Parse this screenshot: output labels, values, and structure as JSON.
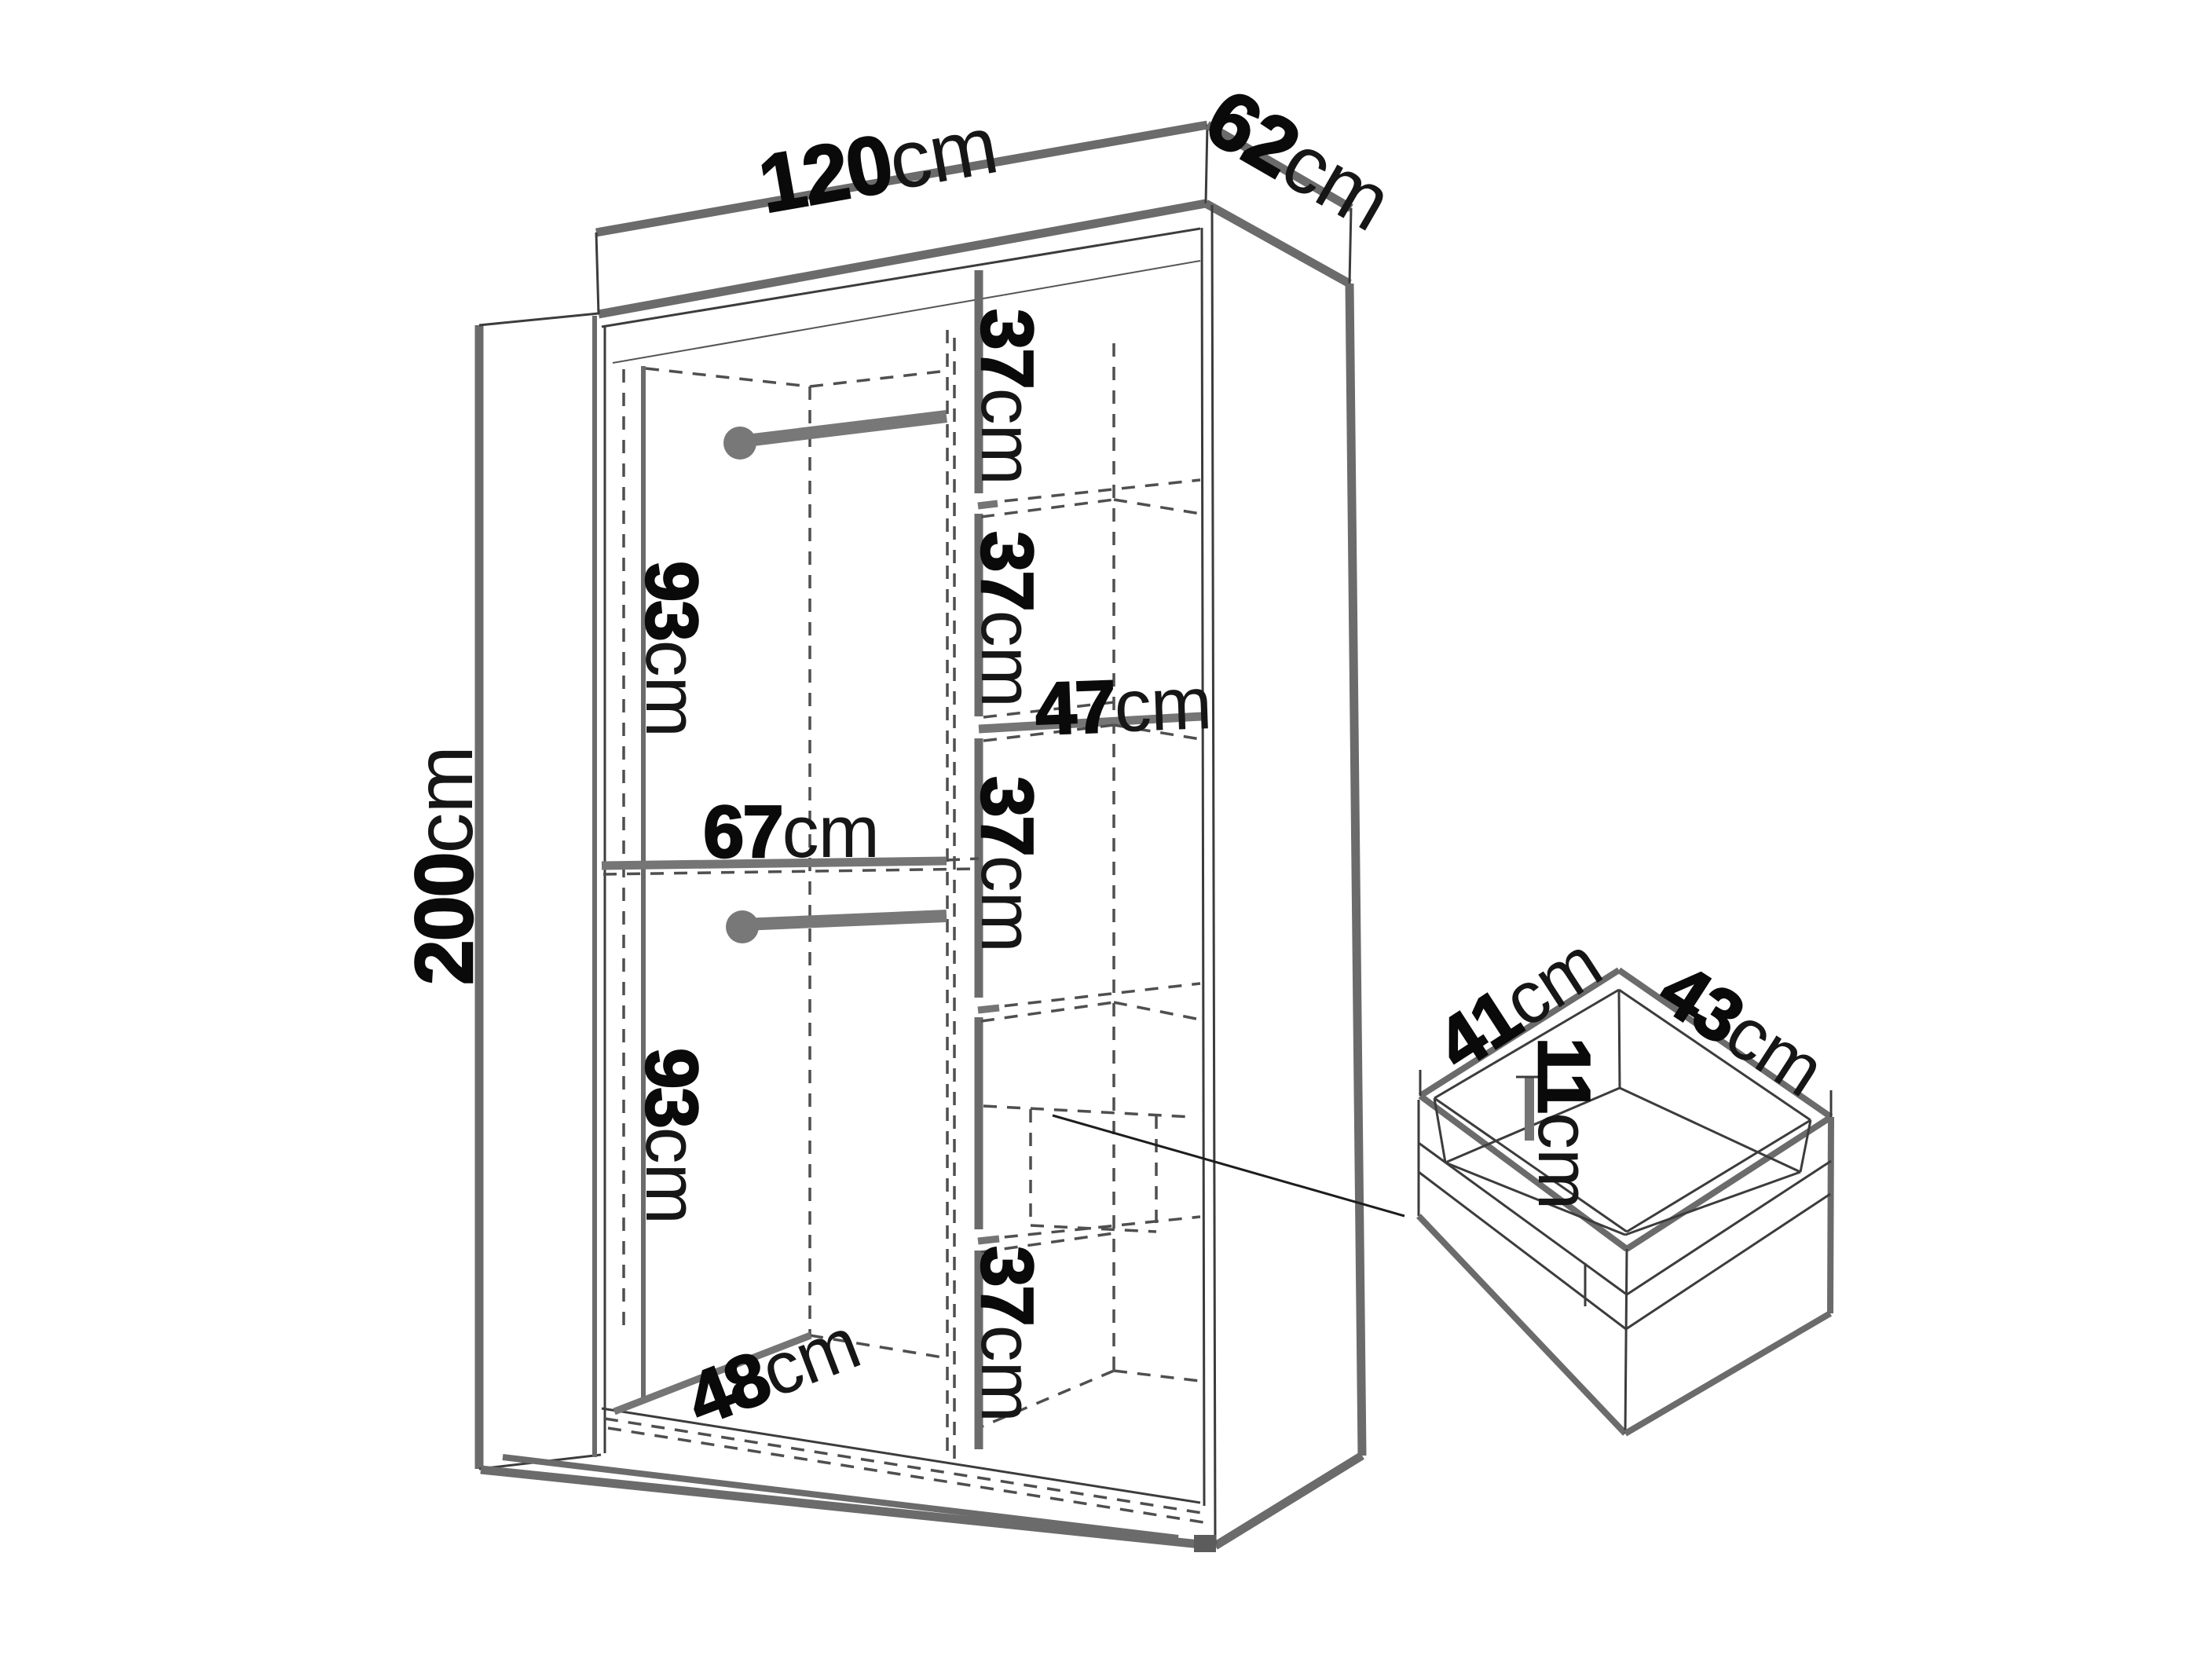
{
  "diagram": {
    "kind": "wardrobe-dimension-diagram",
    "unit": "cm",
    "colors": {
      "background": "#ffffff",
      "thick_line": "#6b6b6b",
      "thin_line": "#3c3c3c",
      "dashed_line": "#4f4f4f",
      "fitting_gray": "#787878",
      "text": "#0a0a0a"
    },
    "wardrobe": {
      "width": "120",
      "depth": "62",
      "height": "200",
      "interior": {
        "hanging_top": "93",
        "hanging_bottom": "93",
        "left_section_width": "67",
        "left_section_depth": "48",
        "shelf_spacing": [
          "37",
          "37",
          "37",
          "37"
        ],
        "shelf_width": "47"
      }
    },
    "drawer": {
      "depth": "41",
      "width": "43",
      "height": "11"
    }
  }
}
